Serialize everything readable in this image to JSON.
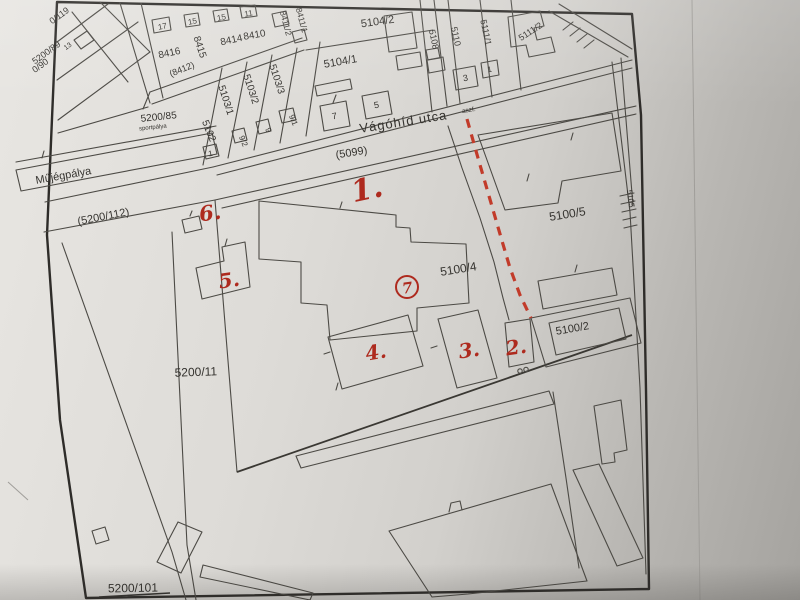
{
  "document": {
    "kind": "scanned cadastral map photo",
    "colors": {
      "paper": "#dddbd7",
      "ink": "#4c4a45",
      "frame": "#2e2c29",
      "annotation_red": "#ae2a1e",
      "dashed_line_red": "#c23b2a"
    }
  },
  "labels": {
    "p0_119": "0/119",
    "p5200_89": "5200/89",
    "h13": "13",
    "p0_90": "0/90",
    "p8416": "8416",
    "h17": "17",
    "p8415": "8415",
    "h15a": "15",
    "p8414": "8414",
    "h15b": "15",
    "p8410": "8410",
    "h11": "11",
    "p8412": "(8412)",
    "p8411_2": "8411/2",
    "p8411_1": "8411/1",
    "p5102": "5102",
    "h1a": "1",
    "p5103_1": "5103/1",
    "h9_2": "9/2",
    "p5103_2": "5103/2",
    "h9": "9",
    "p5103_3": "5103/3",
    "h9_1": "9/1",
    "p5104_1": "5104/1",
    "h7": "7",
    "h5": "5",
    "p5104_2": "5104/2",
    "p5108": "5108",
    "p5110": "5110",
    "h3": "3",
    "p5111_1": "5111/1",
    "h1b": "1",
    "p5111_2": "5111/2",
    "road5099": "(5099)",
    "vagohid": "Vágóhíd utca",
    "vagohid_suffix": "aszf.",
    "p5105": "5105",
    "p5100_5": "5100/5",
    "p5100_4": "5100/4",
    "p5100_2": "5100/2",
    "mujegpalya": "Műjégpálya",
    "road5200_112": "(5200/112)",
    "p5200_85": "5200/85",
    "sportpalya": "sportpálya",
    "p5200_11": "5200/11",
    "p5200_101": "5200/101"
  },
  "markers": {
    "m1": "1.",
    "m2": "2.",
    "m3": "3.",
    "m4": "4.",
    "m5": "5.",
    "m6": "6.",
    "m7": "7"
  }
}
